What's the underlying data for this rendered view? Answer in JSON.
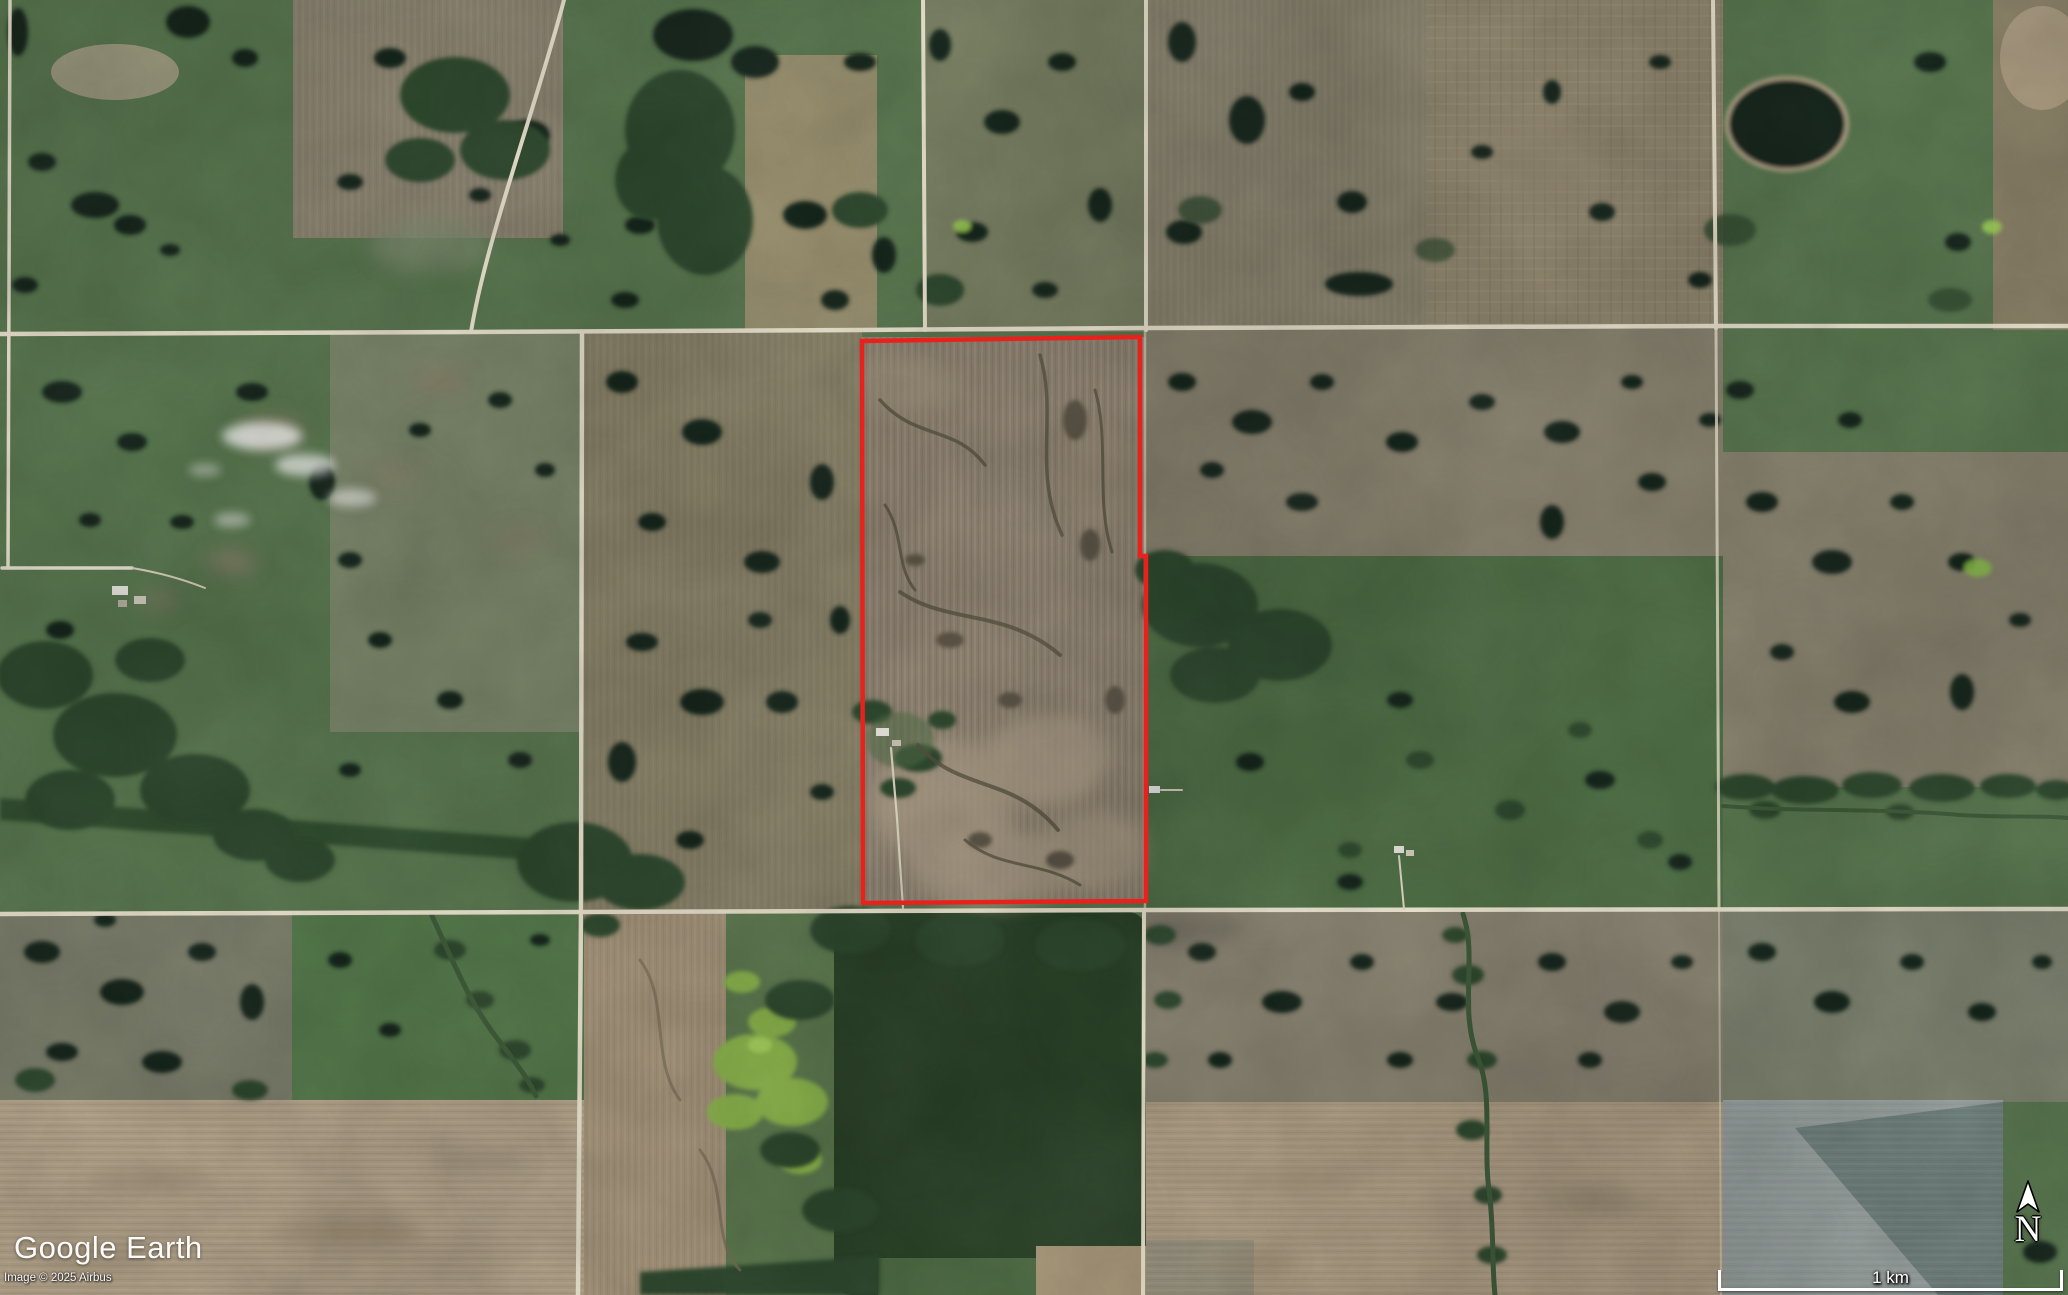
{
  "attribution": {
    "logo": "Google Earth",
    "copyright": "Image © 2025 Airbus"
  },
  "hud": {
    "compass_label": "N",
    "scale_label": "1 km"
  },
  "theme": {
    "base-green": "#5a7850",
    "road": "#ece5d0",
    "parcel-red": "#e8211c",
    "water-dark": "#15251a",
    "forest-green": "#2e4a2e",
    "marsh-lime": "#8db84e",
    "field-tan": "#b2a289",
    "field-grey": "#98a19f",
    "hud-white": "#ffffff"
  }
}
